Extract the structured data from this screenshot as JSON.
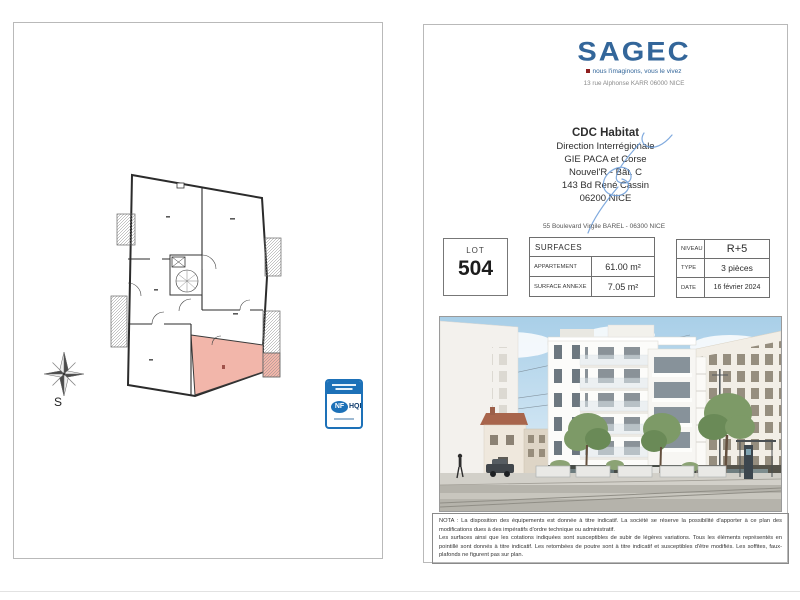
{
  "left_page": {
    "compass_label": "S",
    "badge": {
      "nf_label": "NF",
      "hqe_label": "HQE"
    }
  },
  "right_page": {
    "logo": {
      "name": "SAGEC",
      "tagline": "nous l'imaginons, vous le vivez",
      "address": "13 rue Alphonse KARR 06000 NICE"
    },
    "recipient": {
      "lines": [
        "CDC Habitat",
        "Direction Interrégionale",
        "GIE PACA et Corse",
        "Nouvel'R - Bât. C",
        "143 Bd René Cassin",
        "06200 NICE"
      ]
    },
    "project_address": "55 Boulevard Virgile BAREL - 06300 NICE",
    "lot": {
      "label": "LOT",
      "number": "504"
    },
    "surfaces": {
      "header": "SURFACES",
      "rows": [
        {
          "label": "APPARTEMENT",
          "value": "61.00 m²"
        },
        {
          "label": "SURFACE ANNEXE",
          "value": "7.05 m²"
        }
      ]
    },
    "details": {
      "rows": [
        {
          "label": "NIVEAU",
          "value": "R+5"
        },
        {
          "label": "TYPE",
          "value": "3 pièces"
        },
        {
          "label": "DATE",
          "value": "16 février 2024"
        }
      ]
    },
    "nota": {
      "p1": "NOTA : La disposition des équipements est donnée à titre indicatif. La société se réserve la possibilité d'apporter à ce plan des modifications dues à des impératifs d'ordre technique ou administratif.",
      "p2": "Les surfaces ainsi que les cotations indiquées sont susceptibles de subir de légères variations. Tous les éléments représentés en pointillé sont donnés à titre indicatif. Les retombées de poutre sont à titre indicatif et susceptibles d'être modifiés. Les soffites, faux-plafonds ne figurent pas sur plan."
    }
  },
  "colors": {
    "logo_blue": "#33669a",
    "accent_red": "#8e1f1f",
    "badge_blue": "#1d71b8",
    "lot_highlight_pink": "#f2b6aa",
    "sky_blue": "#a9cfe8"
  }
}
